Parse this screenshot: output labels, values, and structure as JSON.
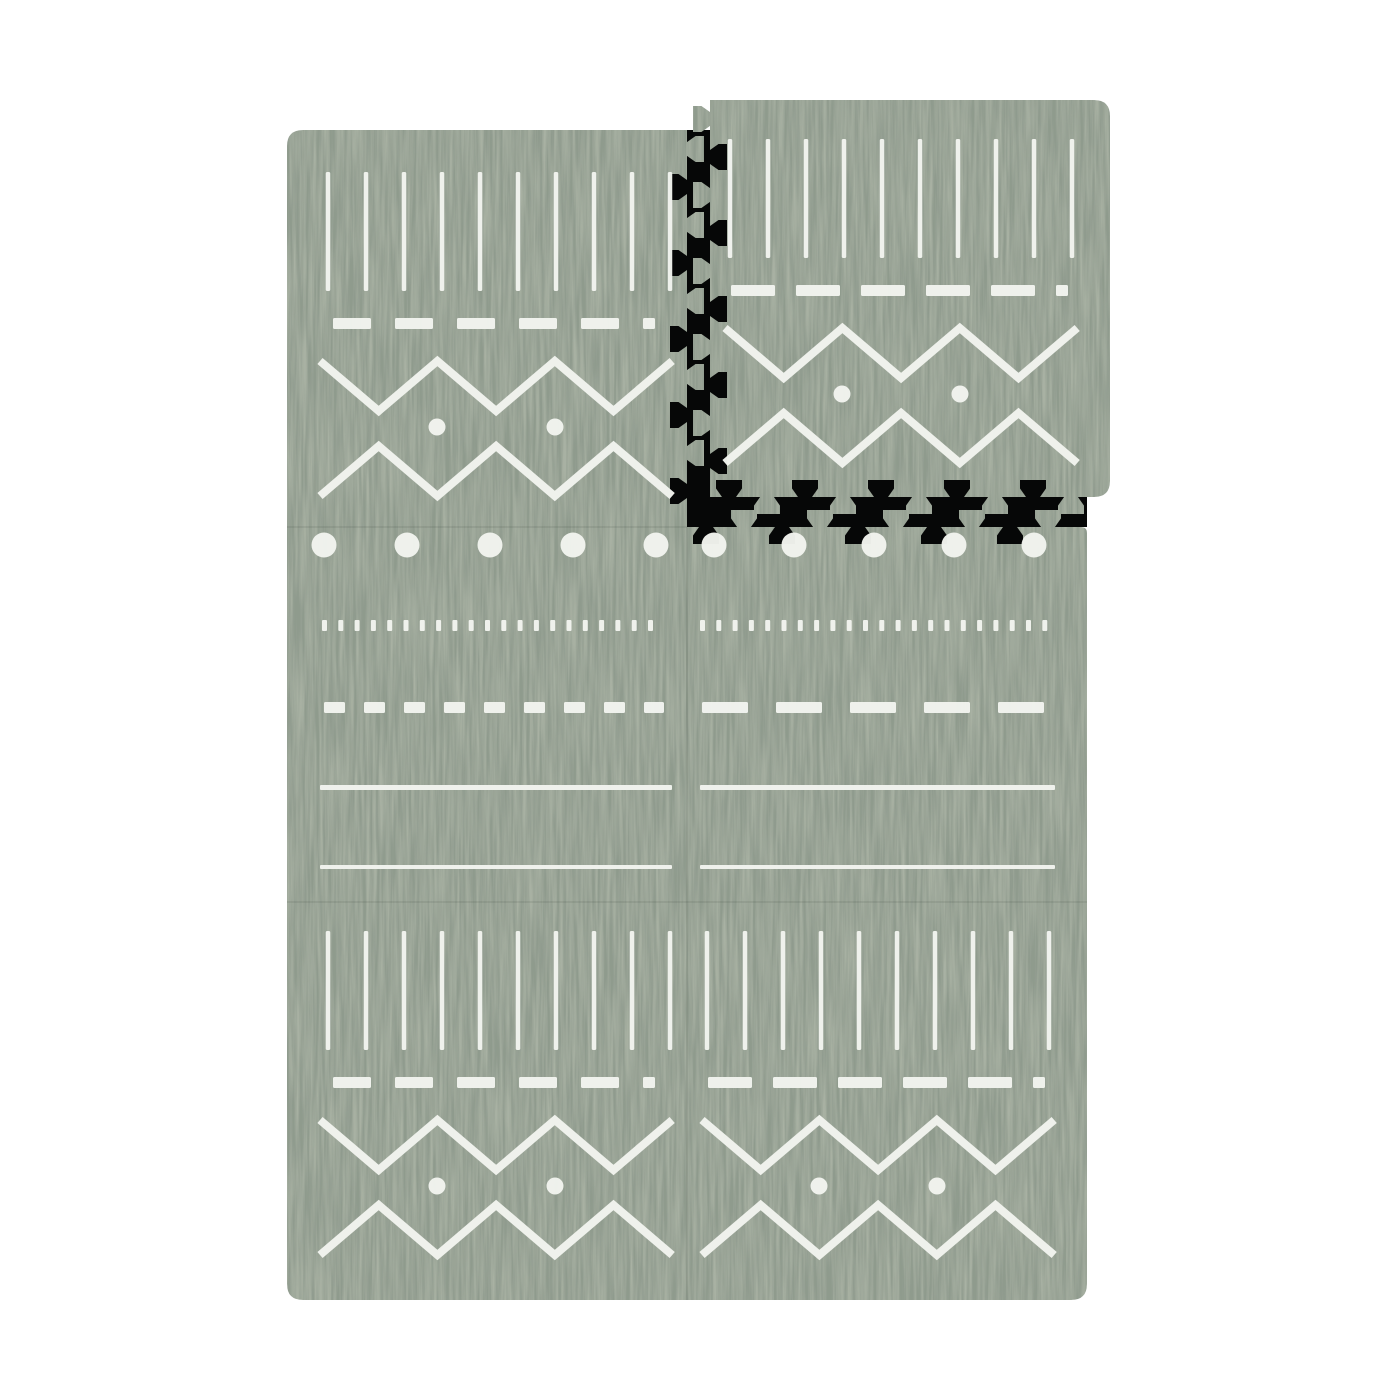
{
  "scene": {
    "background_color": "#ffffff",
    "shadow_color": "#060707",
    "colors": {
      "foam_base": "#a8b1a3",
      "foam_streak": "#6f8074",
      "print_white": "#f2f4ef",
      "seam": "rgba(45,60,48,0.10)"
    },
    "mat": {
      "x": 287,
      "y": 130,
      "right": 1087,
      "bottom": 1300,
      "tile_width": 400,
      "corner_radius": 16,
      "socket": {
        "x": 687,
        "y": 130,
        "w": 400,
        "h": 397
      }
    },
    "detached_tile": {
      "x": 710,
      "y": 100,
      "w": 400,
      "h": 397,
      "corner_radius": 16
    },
    "teeth": {
      "pitch": 38,
      "head": 26,
      "neck": 14,
      "depth": 17,
      "start_margin": 19
    },
    "edges": [
      {
        "name": "socket-left-teeth",
        "part": "mat",
        "orient": "v",
        "pos": 687,
        "from": 130,
        "to": 527,
        "out": 1,
        "start": "tab"
      },
      {
        "name": "socket-bottom-teeth",
        "part": "mat",
        "orient": "h",
        "pos": 527,
        "from": 687,
        "to": 1087,
        "out": -1,
        "start": "notch"
      },
      {
        "name": "tile-left-teeth",
        "part": "tile",
        "orient": "v",
        "pos": 710,
        "from": 100,
        "to": 497,
        "out": -1,
        "start": "tab"
      },
      {
        "name": "tile-bottom-teeth",
        "part": "tile",
        "orient": "h",
        "pos": 497,
        "from": 710,
        "to": 1110,
        "out": 1,
        "start": "notch"
      }
    ],
    "tiles": [
      {
        "name": "tile-top-left",
        "design": "A",
        "x": 287,
        "y": 130,
        "dy": 0
      },
      {
        "name": "tile-middle-left",
        "design": "B1",
        "x": 287,
        "y": 527,
        "dy": 0
      },
      {
        "name": "tile-middle-right",
        "design": "B2",
        "x": 687,
        "y": 527,
        "dy": 0
      },
      {
        "name": "tile-bottom-left",
        "design": "A",
        "x": 287,
        "y": 902,
        "dy": -13
      },
      {
        "name": "tile-bottom-right",
        "design": "A2",
        "x": 687,
        "y": 902,
        "dy": -13
      },
      {
        "name": "tile-detached",
        "design": "A2",
        "x": 710,
        "y": 100,
        "dy": -3,
        "detached": true
      }
    ],
    "designs": {
      "A": {
        "vlines": {
          "x0": 41,
          "step": 38,
          "count": 10,
          "y0": 42,
          "y1": 161,
          "w": 4.5
        },
        "dash": {
          "y": 188,
          "h": 11,
          "x0": 46,
          "x1": 368,
          "dash": 38,
          "gap": 24
        },
        "zig_top": {
          "x0": 33,
          "half": 58.7,
          "n": 6,
          "y_a": 231,
          "y_b": 281,
          "w": 8
        },
        "dots": {
          "xs": [
            150,
            268
          ],
          "y": 297,
          "r": 8.5
        },
        "zig_bot": {
          "x0": 33,
          "half": 58.7,
          "n": 6,
          "y_a": 366,
          "y_b": 316,
          "w": 8
        }
      },
      "A2": {
        "vlines": {
          "x0": 20,
          "step": 38,
          "count": 10,
          "y0": 42,
          "y1": 161,
          "w": 4.5
        },
        "dash": {
          "y": 188,
          "h": 11,
          "x0": 21,
          "x1": 358,
          "dash": 44,
          "gap": 21
        },
        "zig_top": {
          "x0": 15,
          "half": 58.7,
          "n": 6,
          "y_a": 231,
          "y_b": 281,
          "w": 8
        },
        "dots": {
          "xs": [
            132,
            250
          ],
          "y": 297,
          "r": 8.5
        },
        "zig_bot": {
          "x0": 15,
          "half": 58.7,
          "n": 6,
          "y_a": 366,
          "y_b": 316,
          "w": 8
        }
      },
      "B1": {
        "bigdots": {
          "xs": [
            37,
            120,
            203,
            286,
            369
          ],
          "y": 18,
          "r": 12.5
        },
        "micro": {
          "y": 93,
          "h": 11,
          "w": 5,
          "step": 16.3,
          "x0": 35,
          "x1": 366
        },
        "dash": {
          "y": 175,
          "h": 11,
          "x0": 37,
          "x1": 377,
          "dash": 21,
          "gap": 19
        },
        "lines": [
          {
            "y": 258,
            "h": 5,
            "x0": 33,
            "x1": 385
          },
          {
            "y": 338,
            "h": 4,
            "x0": 33,
            "x1": 385
          }
        ]
      },
      "B2": {
        "bigdots": {
          "xs": [
            27,
            107,
            187,
            267,
            347
          ],
          "y": 18,
          "r": 12.5
        },
        "micro": {
          "y": 93,
          "h": 11,
          "w": 5,
          "step": 16.3,
          "x0": 13,
          "x1": 363
        },
        "dash": {
          "y": 175,
          "h": 11,
          "x0": 15,
          "x1": 368,
          "dash": 46,
          "gap": 28
        },
        "lines": [
          {
            "y": 258,
            "h": 5,
            "x0": 13,
            "x1": 368
          },
          {
            "y": 338,
            "h": 4,
            "x0": 13,
            "x1": 368
          }
        ]
      }
    },
    "seams": [
      {
        "x1": 687,
        "y1": 527,
        "x2": 687,
        "y2": 1300
      },
      {
        "x1": 287,
        "y1": 527,
        "x2": 687,
        "y2": 527
      },
      {
        "x1": 287,
        "y1": 902,
        "x2": 1087,
        "y2": 902
      }
    ]
  }
}
